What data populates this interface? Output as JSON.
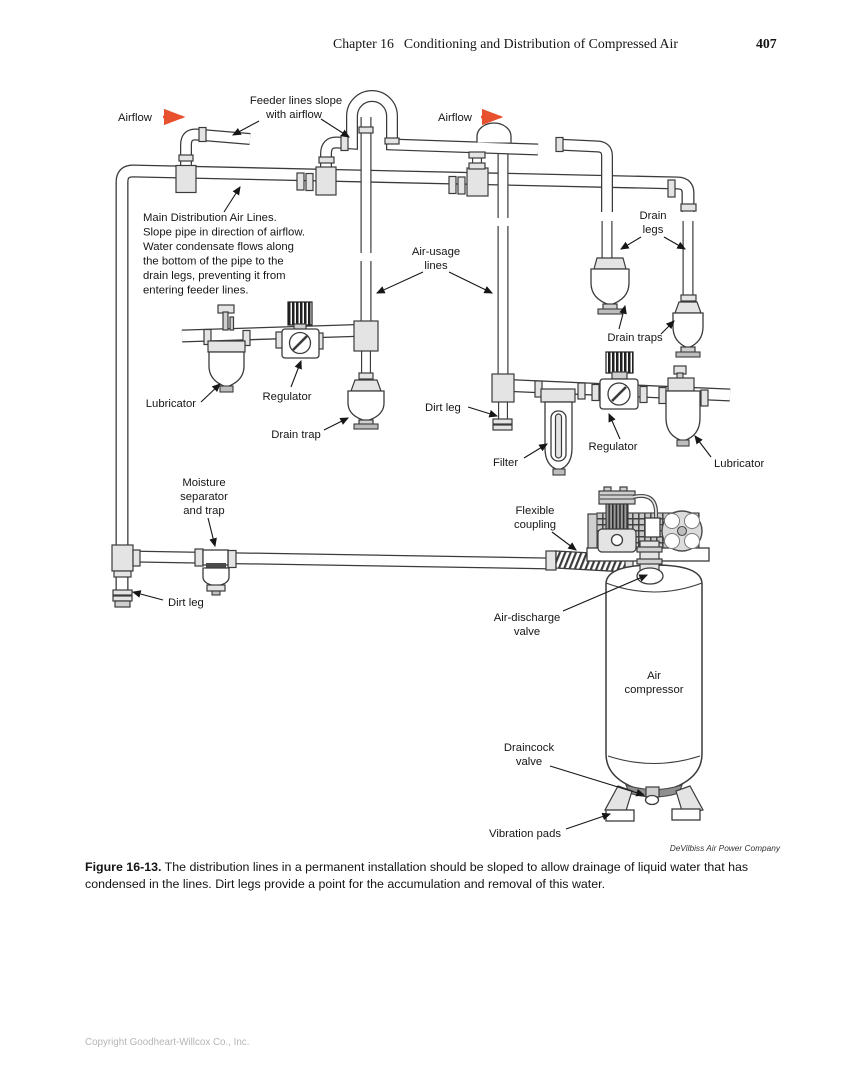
{
  "header": {
    "chapter": "Chapter 16",
    "title": "Conditioning and Distribution of Compressed Air",
    "page_number": "407"
  },
  "diagram": {
    "colors": {
      "airflow_arrow": "#e8512e",
      "line_art": "#3b3b3b"
    },
    "labels": {
      "airflow_left": "Airflow",
      "airflow_right": "Airflow",
      "feeder_lines_slope": [
        "Feeder lines slope",
        "with airflow"
      ],
      "main_distribution_note": [
        "Main Distribution Air Lines.",
        "Slope pipe in direction of airflow.",
        "Water condensate flows along",
        "the bottom of the pipe to the",
        "drain legs, preventing it from",
        "entering feeder lines."
      ],
      "air_usage_lines": [
        "Air-usage",
        "lines"
      ],
      "drain_legs": [
        "Drain",
        "legs"
      ],
      "drain_traps": "Drain traps",
      "lubricator_left": "Lubricator",
      "regulator_left": "Regulator",
      "drain_trap": "Drain trap",
      "dirt_leg_right": "Dirt leg",
      "filter": "Filter",
      "regulator_right": "Regulator",
      "lubricator_right": "Lubricator",
      "moisture_separator": [
        "Moisture",
        "separator",
        "and trap"
      ],
      "dirt_leg_left": "Dirt leg",
      "flexible_coupling": [
        "Flexible",
        "coupling"
      ],
      "air_discharge_valve": [
        "Air-discharge",
        "valve"
      ],
      "air_compressor": [
        "Air",
        "compressor"
      ],
      "draincock_valve": [
        "Draincock",
        "valve"
      ],
      "vibration_pads": "Vibration pads",
      "credit": "DeVilbiss Air Power Company"
    }
  },
  "caption": {
    "figure_label": "Figure 16-13.",
    "text": "The distribution lines in a permanent installation should be sloped to allow drainage of liquid water that has condensed in the lines. Dirt legs provide a point for the accumulation and removal of this water."
  },
  "footer": {
    "copyright": "Copyright Goodheart-Willcox Co., Inc."
  }
}
